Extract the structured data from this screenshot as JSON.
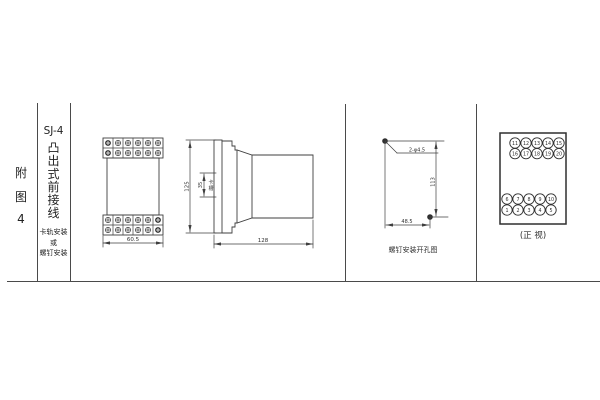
{
  "page": {
    "background": "#ffffff",
    "line_color": "#3f3f3f",
    "fig_label_chars": [
      "附",
      "图",
      "4"
    ],
    "series_label": "SJ-4",
    "title_chars": [
      "凸",
      "出",
      "式",
      "前",
      "接",
      "线"
    ],
    "mount_lines": [
      "卡轨安装",
      "或",
      "螺钉安装"
    ]
  },
  "outline_view": {
    "width_dim": "60.5"
  },
  "side_view": {
    "height_dim": "125",
    "slot_dim": "35",
    "slot_label_chars": [
      "卡",
      "槽"
    ],
    "depth_dim": "128"
  },
  "drill_view": {
    "hole_label": "2-φ4.5",
    "vertical_dim": "113",
    "horizontal_dim": "48.5",
    "caption": "螺钉安装开孔图"
  },
  "front_view": {
    "caption": "(正 视)",
    "rows": [
      [
        "11",
        "12",
        "13",
        "14",
        "15"
      ],
      [
        "16",
        "17",
        "18",
        "19",
        "20"
      ],
      [
        "6",
        "7",
        "8",
        "9",
        "10"
      ],
      [
        "1",
        "2",
        "3",
        "4",
        "5"
      ]
    ]
  }
}
